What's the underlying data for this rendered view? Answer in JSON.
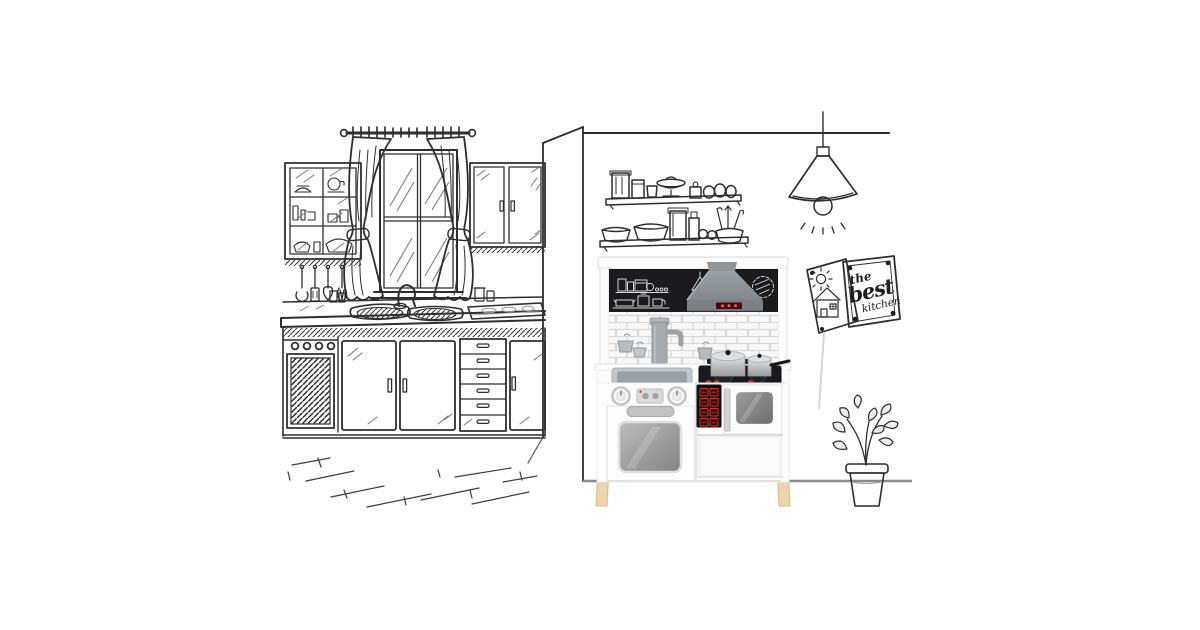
{
  "canvas": {
    "width": 1200,
    "height": 630,
    "background": "#ffffff"
  },
  "poster": {
    "the": "the",
    "best": "best",
    "kitchen": "kitchen"
  },
  "colors": {
    "sketch_ink": "#2e2e2e",
    "chalkboard": "#1b1b1d",
    "chalk": "#e4e4e4",
    "hood_gray": "#8f9397",
    "hood_display": "#40090b",
    "hood_display_dots": "#e2685d",
    "led_panel": "#101010",
    "led_red": "#d8352b",
    "cooktop_black": "#1a1a1e",
    "cooktop_red_marks": "#c4372c",
    "sink_gray": "#9aa0a3",
    "pot_silver": "#d2d4d5",
    "wood_leg": "#ecd6ab",
    "floor_line_gray": "#8a8a8a",
    "toy_kitchen_body": "#fdfdfd"
  },
  "scene": {
    "style": "hand-drawn pen sketch of a kitchen with a composited product photo of a white wooden toy play kitchen",
    "left_room_items": [
      "glass display cabinet with dishes",
      "hanging utensils: ladle, spatula, slotted spoon, whisk",
      "window with curtain rod and two tied-back curtains",
      "upper double-door cabinet",
      "counter with double sink and gooseneck faucet",
      "dark hatched cooktop",
      "oven with four knobs and hatched door",
      "two cabinet doors",
      "six-drawer unit",
      "narrow cabinet door",
      "sketched floorboards"
    ],
    "right_room_items": [
      "ceiling line",
      "pendant cone lamp with glowing bulb",
      "upper wall shelf with jars, footed dish and eggs",
      "lower wall shelf with bowls, jars and utensil pot",
      "pinned poster with sun and house child drawing",
      "pinned poster with lettering",
      "faint leaning line",
      "potted plant with leafy stems",
      "gray floor line"
    ],
    "toy_kitchen_features": [
      "white top board",
      "black chalkboard panel with chalk doodles of jars, pots, pendant lamp and round badge",
      "gray range hood with red button strip",
      "white subway-brick backsplash",
      "gray play faucet and hanging mini pots",
      "gray square sink basin",
      "black cooktop with two stainless pots and red digit marks",
      "two silver control knobs with small display",
      "oven door with gray handle and window",
      "black panel with red digital buttons",
      "microwave door with window",
      "open lower shelf",
      "four natural wooden legs"
    ]
  }
}
